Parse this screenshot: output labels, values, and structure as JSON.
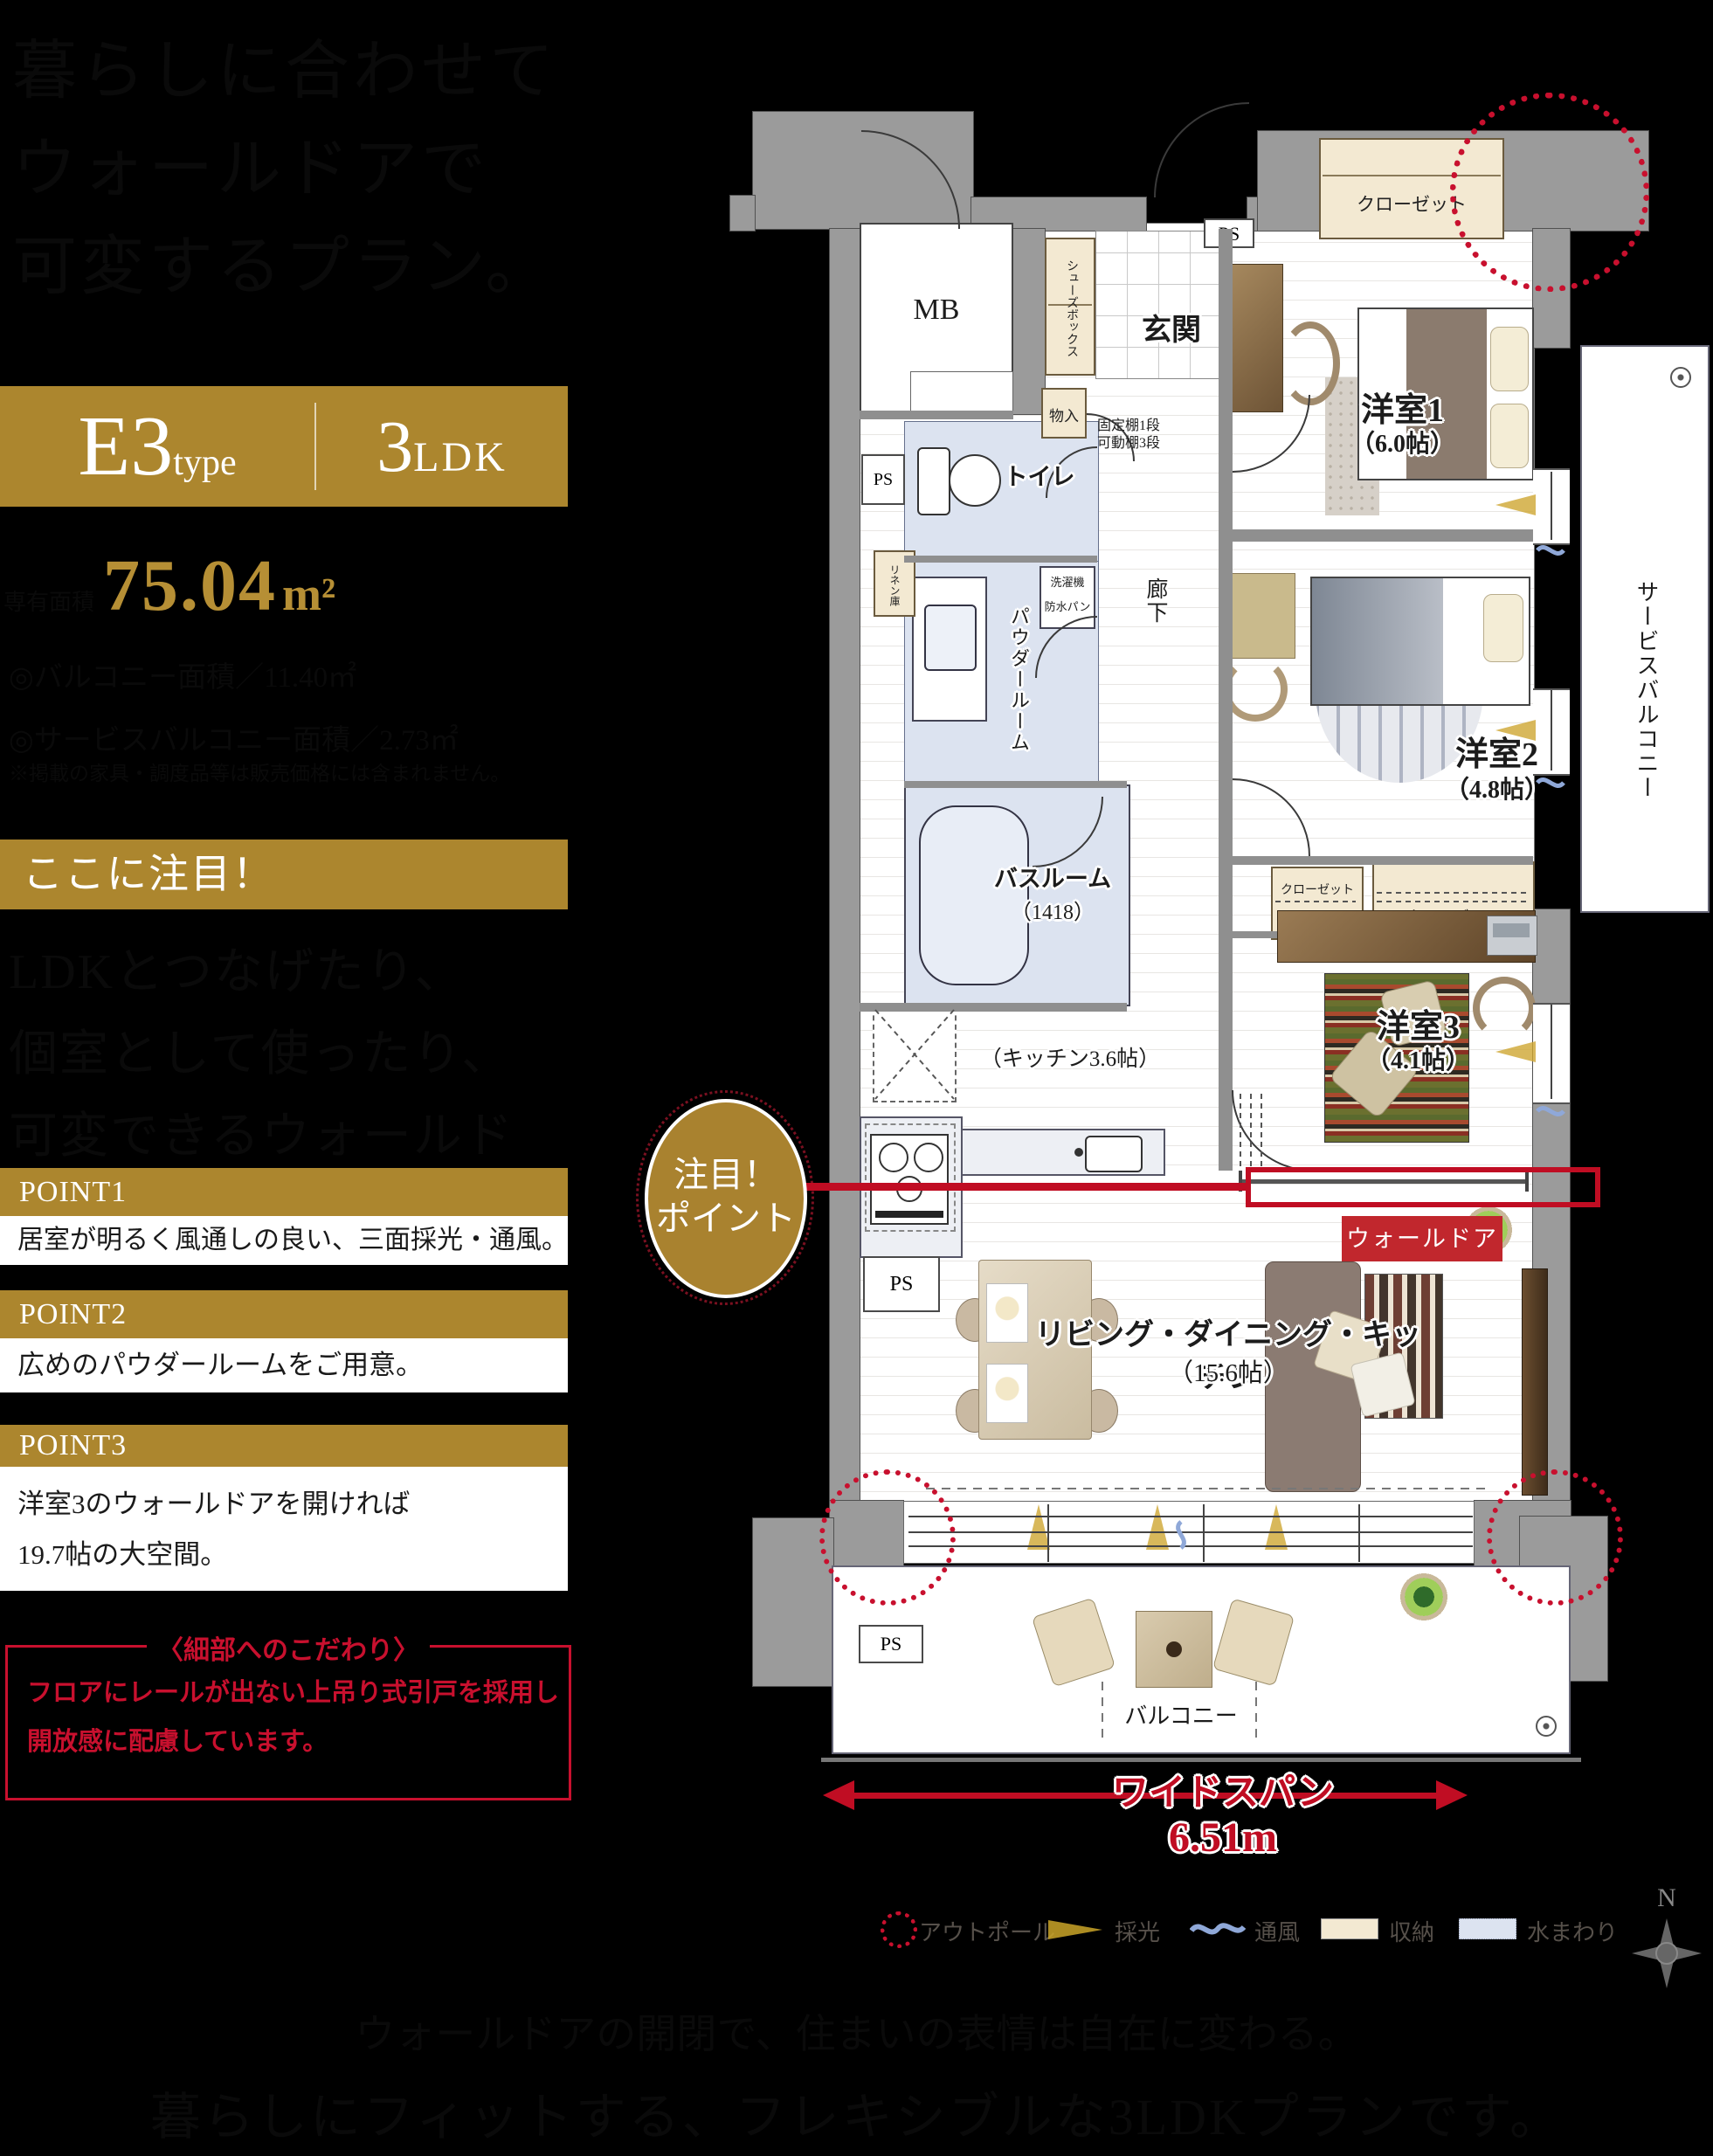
{
  "left": {
    "heading_lines": [
      "暮らしに合わせて",
      "ウォールドアで",
      "可変するプラン。"
    ],
    "type_box": {
      "name": "E3",
      "name_suffix": "type",
      "plan_rooms": "3",
      "plan_suffix": "LDK"
    },
    "area": {
      "label": "専有面積",
      "value": "75.04",
      "unit": "m²"
    },
    "sub_bullets": [
      "◎バルコニー面積／11.40㎡",
      "◎サービスバルコニー面積／2.73㎡"
    ],
    "note": "※掲載の家具・調度品等は販売価格には含まれません。",
    "attention_bar": "ここに注目！",
    "lead_lines": [
      "LDKとつなげたり、",
      "個室として使ったり、",
      "可変できるウォールドア。"
    ],
    "points": [
      {
        "label": "POINT1",
        "line1": "居室が明るく風通しの良い、三面採光・通風。"
      },
      {
        "label": "POINT2",
        "line1": "広めのパウダールームをご用意。"
      },
      {
        "label": "POINT3",
        "line1": "洋室3のウォールドアを開ければ",
        "line2": "19.7帖の大空間。"
      }
    ],
    "detail_box": {
      "title": "〈細部へのこだわり〉",
      "line1": "フロアにレールが出ない上吊り式引戸を採用し",
      "line2": "開放感に配慮しています。"
    }
  },
  "plan": {
    "rooms": {
      "mb": "MB",
      "shoes_box": "シューズボックス",
      "genkan": "玄関",
      "ps": "PS",
      "storage": "物入",
      "shelf_line1": "固定棚1段",
      "shelf_line2": "可動棚3段",
      "toilet": "トイレ",
      "linen": "リネン庫",
      "washer_line1": "洗濯機",
      "washer_line2": "防水パン",
      "powder": "パウダールーム",
      "hallway": "廊下",
      "bath": "バスルーム",
      "bath_size": "（1418）",
      "kitchen_size": "（キッチン3.6帖）",
      "closet": "クローゼット",
      "room1": "洋室1",
      "room1_size": "（6.0帖）",
      "room2": "洋室2",
      "room2_size": "（4.8帖）",
      "room3": "洋室3",
      "room3_size": "（4.1帖）",
      "service_balcony": "サービスバルコニー",
      "ldk": "リビング・ダイニング・キッチン",
      "ldk_size": "（15.6帖）",
      "balcony": "バルコニー"
    },
    "annotations": {
      "attention_line1": "注目！",
      "attention_line2": "ポイント",
      "wall_door": "ウォールドア",
      "widespan": "ワイドスパン",
      "widespan_value": "6.51m",
      "compass_n": "N"
    },
    "legend": [
      {
        "icon": "outpole-icon",
        "label": "アウトポール"
      },
      {
        "icon": "daylight-icon",
        "label": "採光"
      },
      {
        "icon": "airflow-icon",
        "label": "通風"
      },
      {
        "icon": "storage-icon",
        "label": "収納"
      },
      {
        "icon": "water-icon",
        "label": "水まわり"
      }
    ],
    "colors": {
      "gold": "#AC862E",
      "red": "#C8102E",
      "annotation_red": "#C00D23",
      "label_red_bg": "#C1272D",
      "wall_gray": "#9B9B9B",
      "water_blue": "#DCE3F0",
      "storage_cream": "#F3E9D2"
    }
  },
  "caption_lines": [
    "ウォールドアの開閉で、住まいの表情は自在に変わる。",
    "暮らしにフィットする、フレキシブルな3LDKプランです。"
  ]
}
